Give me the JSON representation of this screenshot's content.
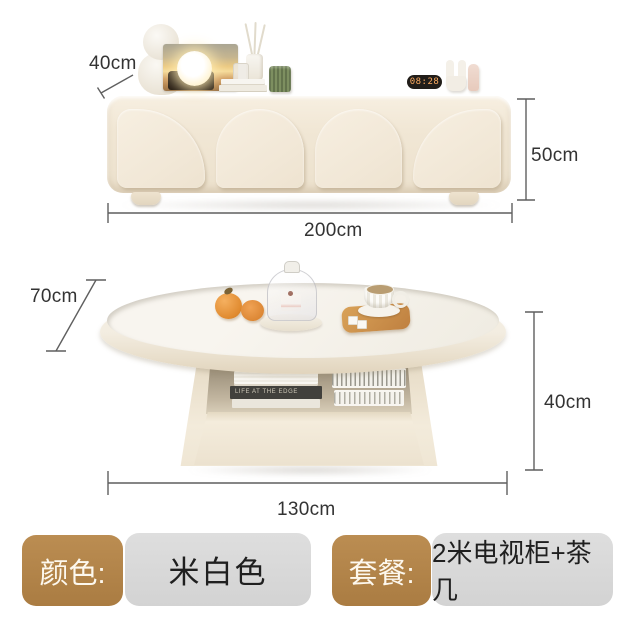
{
  "annotations": {
    "cabinet": {
      "depth_label": "40cm",
      "height_label": "50cm",
      "width_label": "200cm"
    },
    "table": {
      "depth_label": "70cm",
      "height_label": "40cm",
      "width_label": "130cm"
    }
  },
  "decor": {
    "clock_time": "08:28",
    "book_spine_text": "LIFE AT THE EDGE"
  },
  "options": {
    "color": {
      "label": "颜色:",
      "value": "米白色"
    },
    "package": {
      "label": "套餐:",
      "value": "2米电视柜+茶几"
    }
  },
  "colors": {
    "option_label_bg": "#b28449",
    "option_value_bg": "#d9d9d9",
    "cabinet_cream": "#f1e7d5",
    "table_top_white": "#f6f3ed",
    "dimension_line": "#5f5f5f",
    "dimension_text": "#333333",
    "clock_digit": "#ffad61"
  }
}
